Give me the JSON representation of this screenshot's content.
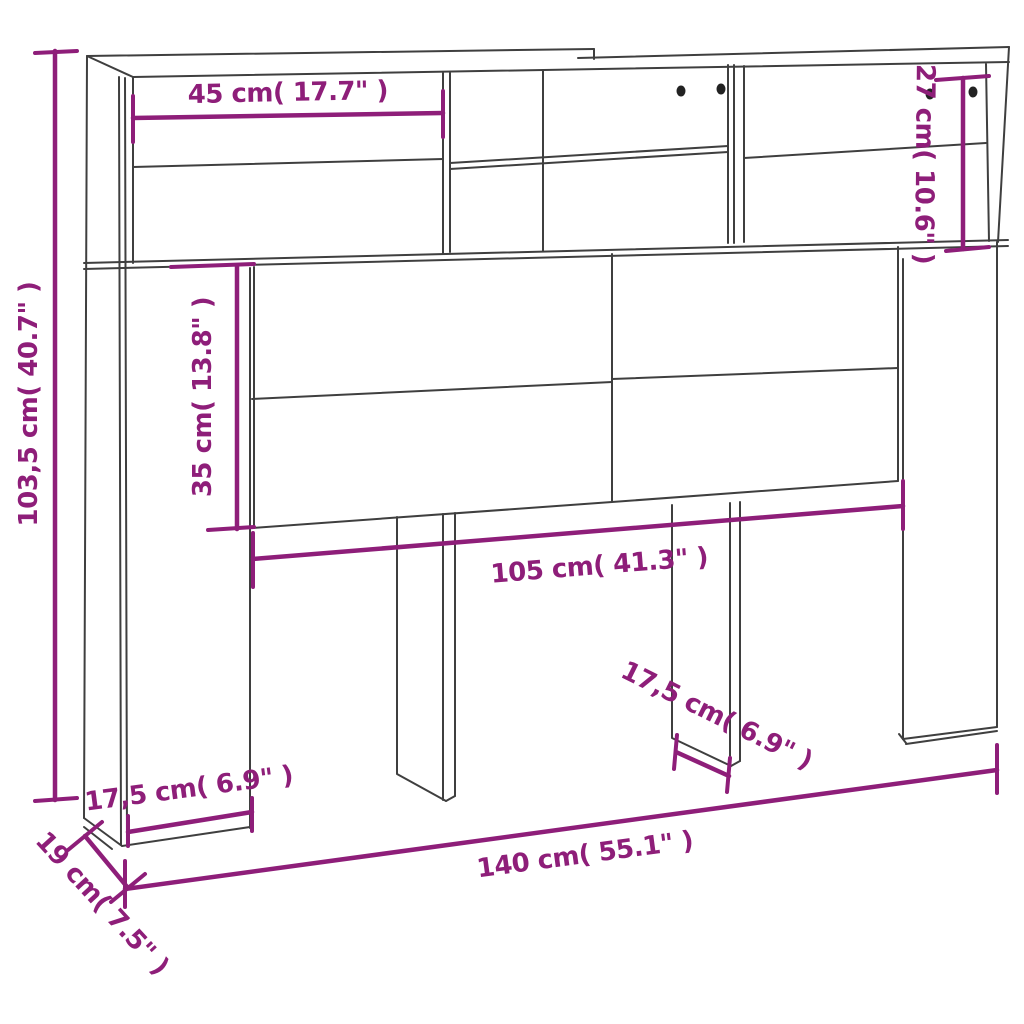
{
  "diagram": {
    "type": "furniture-dimension-drawing",
    "subject": "headboard-cabinet-with-shelves"
  },
  "colors": {
    "dimension_accent": "#8e1e79",
    "outline": "#3f3f3f",
    "background": "#ffffff"
  },
  "dimensions": {
    "overall_height": "103,5 cm( 40.7\" )",
    "top_left_compartment_width": "45 cm( 17.7\" )",
    "top_right_compartment_height": "27 cm( 10.6\" )",
    "side_panel_height_below_shelf": "35 cm( 13.8\" )",
    "inner_width": "105 cm( 41.3\" )",
    "overall_width": "140 cm( 55.1\" )",
    "overall_depth": "19 cm( 7.5\" )",
    "left_panel_depth": "17,5 cm( 6.9\" )",
    "middle_leg_depth": "17,5 cm( 6.9\" )"
  }
}
